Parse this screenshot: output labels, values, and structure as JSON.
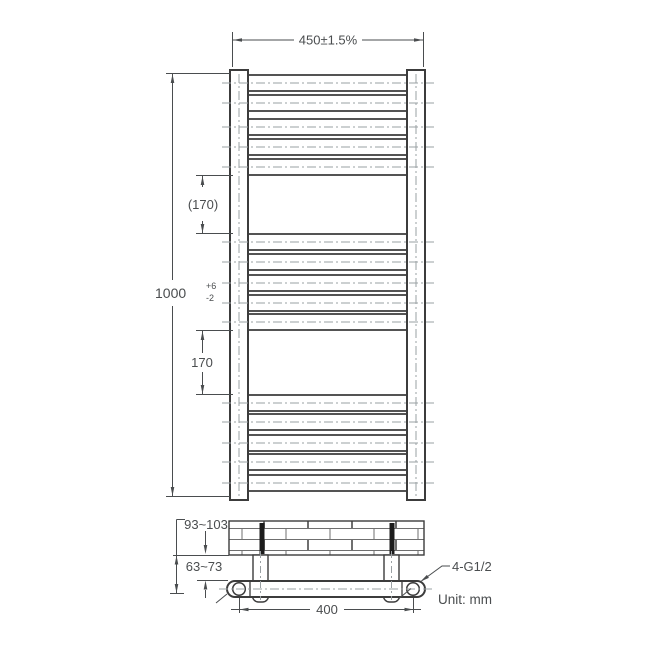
{
  "front_view": {
    "dim_width": "450±1.5%",
    "dim_height": {
      "value": "1000",
      "tol_plus": "+6",
      "tol_minus": "-2"
    },
    "dim_gap_top": "(170)",
    "dim_gap_bottom": "170"
  },
  "side_view": {
    "dim_wall_to_tube_far": "93~103",
    "dim_wall_to_tube_near": "63~73",
    "dim_valve_centers": "400",
    "connection_spec": "4-G1/2",
    "unit_note": "Unit: mm"
  },
  "colors": {
    "line": "#3c3c3c",
    "centerline": "#9aa0a3",
    "text": "#4a4d4f",
    "background": "#ffffff",
    "bracket_stem": "#1c1c1c",
    "brick_line": "#6f6f6f"
  }
}
